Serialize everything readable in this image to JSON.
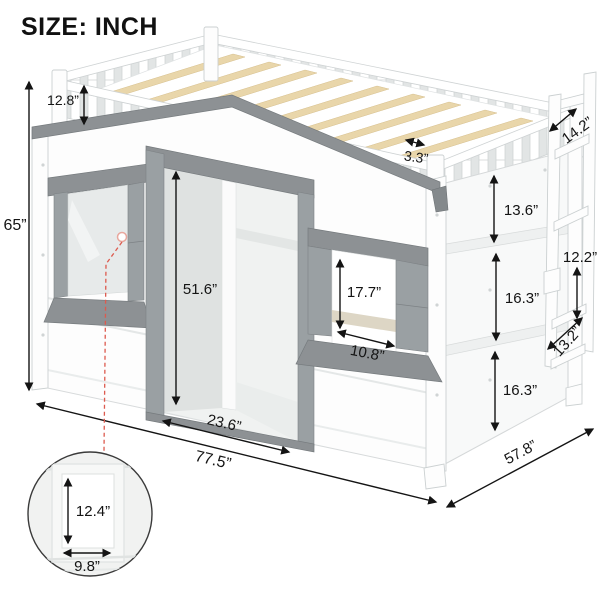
{
  "title": "SIZE: INCH",
  "labels": {
    "total_height": "65”",
    "guardrail_height": "12.8”",
    "slat_spacing": "3.3”",
    "ladder_depth": "14.2”",
    "upper_panel_height": "13.6”",
    "ladder_step_spacing": "12.2”",
    "middle_panel_height": "16.3”",
    "ladder_step_width": "13.2”",
    "lower_panel_height": "16.3”",
    "door_height": "51.6”",
    "window_opening_height": "17.7”",
    "window_opening_width": "10.8”",
    "door_width": "23.6”",
    "bed_length": "77.5”",
    "bed_width": "57.8”",
    "inset_window_height": "12.4”",
    "inset_window_width": "9.8”"
  },
  "colors": {
    "accent_gray": "#8d9194",
    "shutter_gray": "#9aa0a3",
    "wood_slat": "#e9d6aa",
    "leader_red": "#dd5a4e",
    "text": "#141414"
  }
}
